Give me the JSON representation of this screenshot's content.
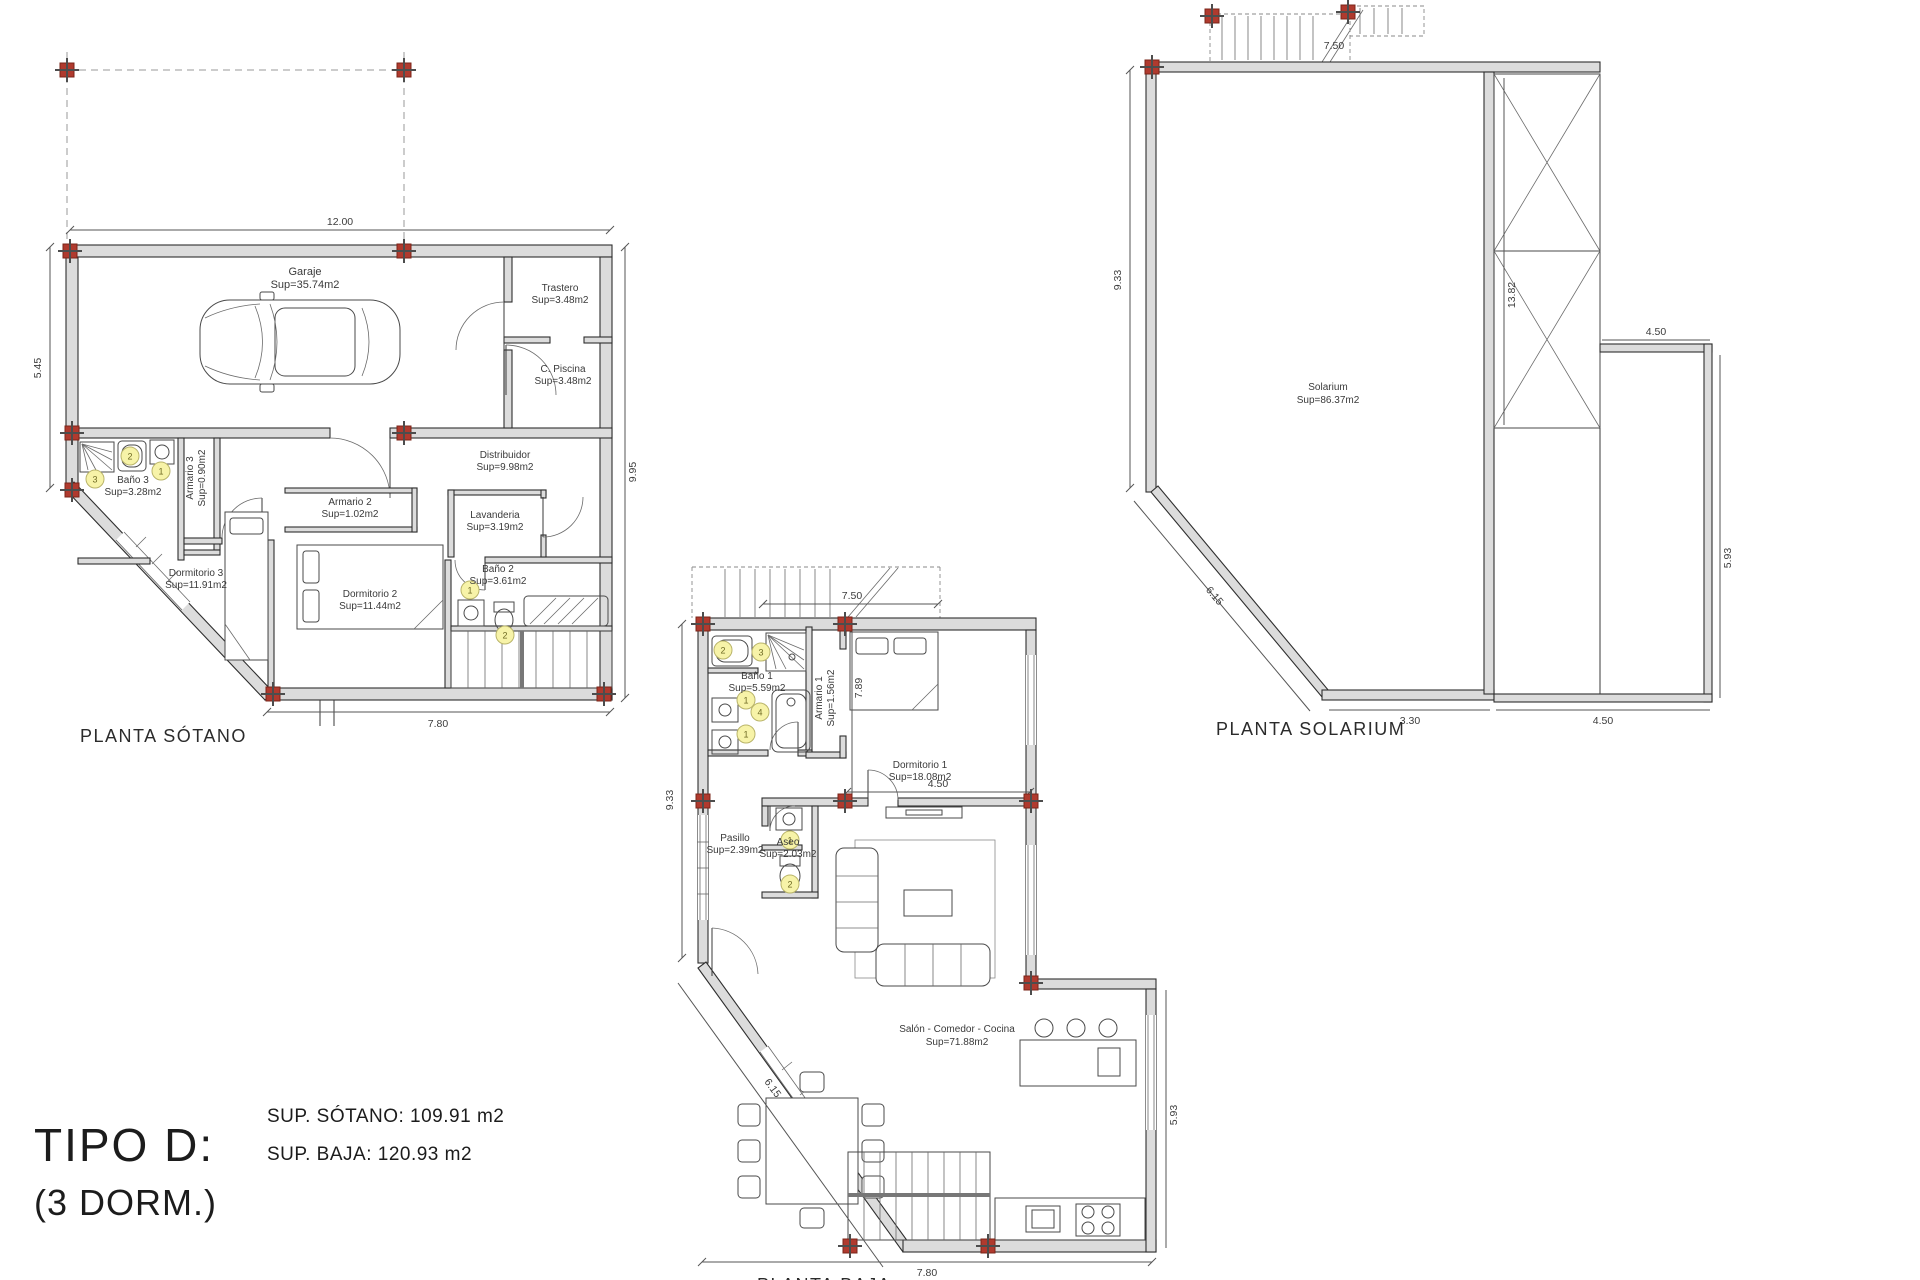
{
  "colors": {
    "wall_fill": "#dcdcdc",
    "line": "#2e2e2e",
    "marker_red": "#b03a2e",
    "badge_yellow": "#f7f3a8"
  },
  "title_block": {
    "tipo": "TIPO D:",
    "dorm": "(3 DORM.)",
    "sup_sotano": "SUP. SÓTANO: 109.91 m2",
    "sup_baja": "SUP. BAJA: 120.93 m2"
  },
  "sotano": {
    "title": "PLANTA SÓTANO",
    "dims": {
      "top": "12.00",
      "left": "5.45",
      "right": "9.95",
      "bottom": "7.80"
    },
    "rooms": {
      "garaje": {
        "name": "Garaje",
        "sup": "Sup=35.74m2"
      },
      "trastero": {
        "name": "Trastero",
        "sup": "Sup=3.48m2"
      },
      "cpiscina": {
        "name": "C. Piscina",
        "sup": "Sup=3.48m2"
      },
      "distribuidor": {
        "name": "Distribuidor",
        "sup": "Sup=9.98m2"
      },
      "bano3": {
        "name": "Baño 3",
        "sup": "Sup=3.28m2"
      },
      "armario3": {
        "name": "Armario 3",
        "sup": "Sup=0.90m2"
      },
      "dormitorio3": {
        "name": "Dormitorio 3",
        "sup": "Sup=11.91m2"
      },
      "armario2": {
        "name": "Armario 2",
        "sup": "Sup=1.02m2"
      },
      "dormitorio2": {
        "name": "Dormitorio 2",
        "sup": "Sup=11.44m2"
      },
      "lavanderia": {
        "name": "Lavanderia",
        "sup": "Sup=3.19m2"
      },
      "bano2": {
        "name": "Baño 2",
        "sup": "Sup=3.61m2"
      }
    },
    "badges": [
      "3",
      "2",
      "1",
      "1",
      "2"
    ]
  },
  "baja": {
    "title": "PLANTA BAJA",
    "dims": {
      "top": "7.50",
      "left": "9.33",
      "inner_h": "7.89",
      "inner_w": "4.50",
      "right": "5.93",
      "bottom": "7.80",
      "diag": "6.15"
    },
    "rooms": {
      "bano1": {
        "name": "Baño 1",
        "sup": "Sup=5.59m2"
      },
      "armario1": {
        "name": "Armario 1",
        "sup": "Sup=1.56m2"
      },
      "dormitorio1": {
        "name": "Dormitorio 1",
        "sup": "Sup=18.08m2"
      },
      "pasillo": {
        "name": "Pasillo",
        "sup": "Sup=2.39m2"
      },
      "aseo": {
        "name": "Aseo",
        "sup": "Sup=2.03m2"
      },
      "salon": {
        "name": "Salón - Comedor - Cocina",
        "sup": "Sup=71.88m2"
      }
    },
    "badges_bano1": [
      "2",
      "3",
      "1",
      "1",
      "4"
    ],
    "badges_aseo": [
      "1",
      "2"
    ]
  },
  "solarium": {
    "title": "PLANTA SOLARIUM",
    "dims": {
      "top": "7.50",
      "left": "9.33",
      "col": "13.82",
      "terrace_w": "4.50",
      "right": "5.93",
      "bottom1": "3.30",
      "bottom2": "4.50",
      "diag": "6.15"
    },
    "rooms": {
      "solarium": {
        "name": "Solarium",
        "sup": "Sup=86.37m2"
      }
    }
  }
}
